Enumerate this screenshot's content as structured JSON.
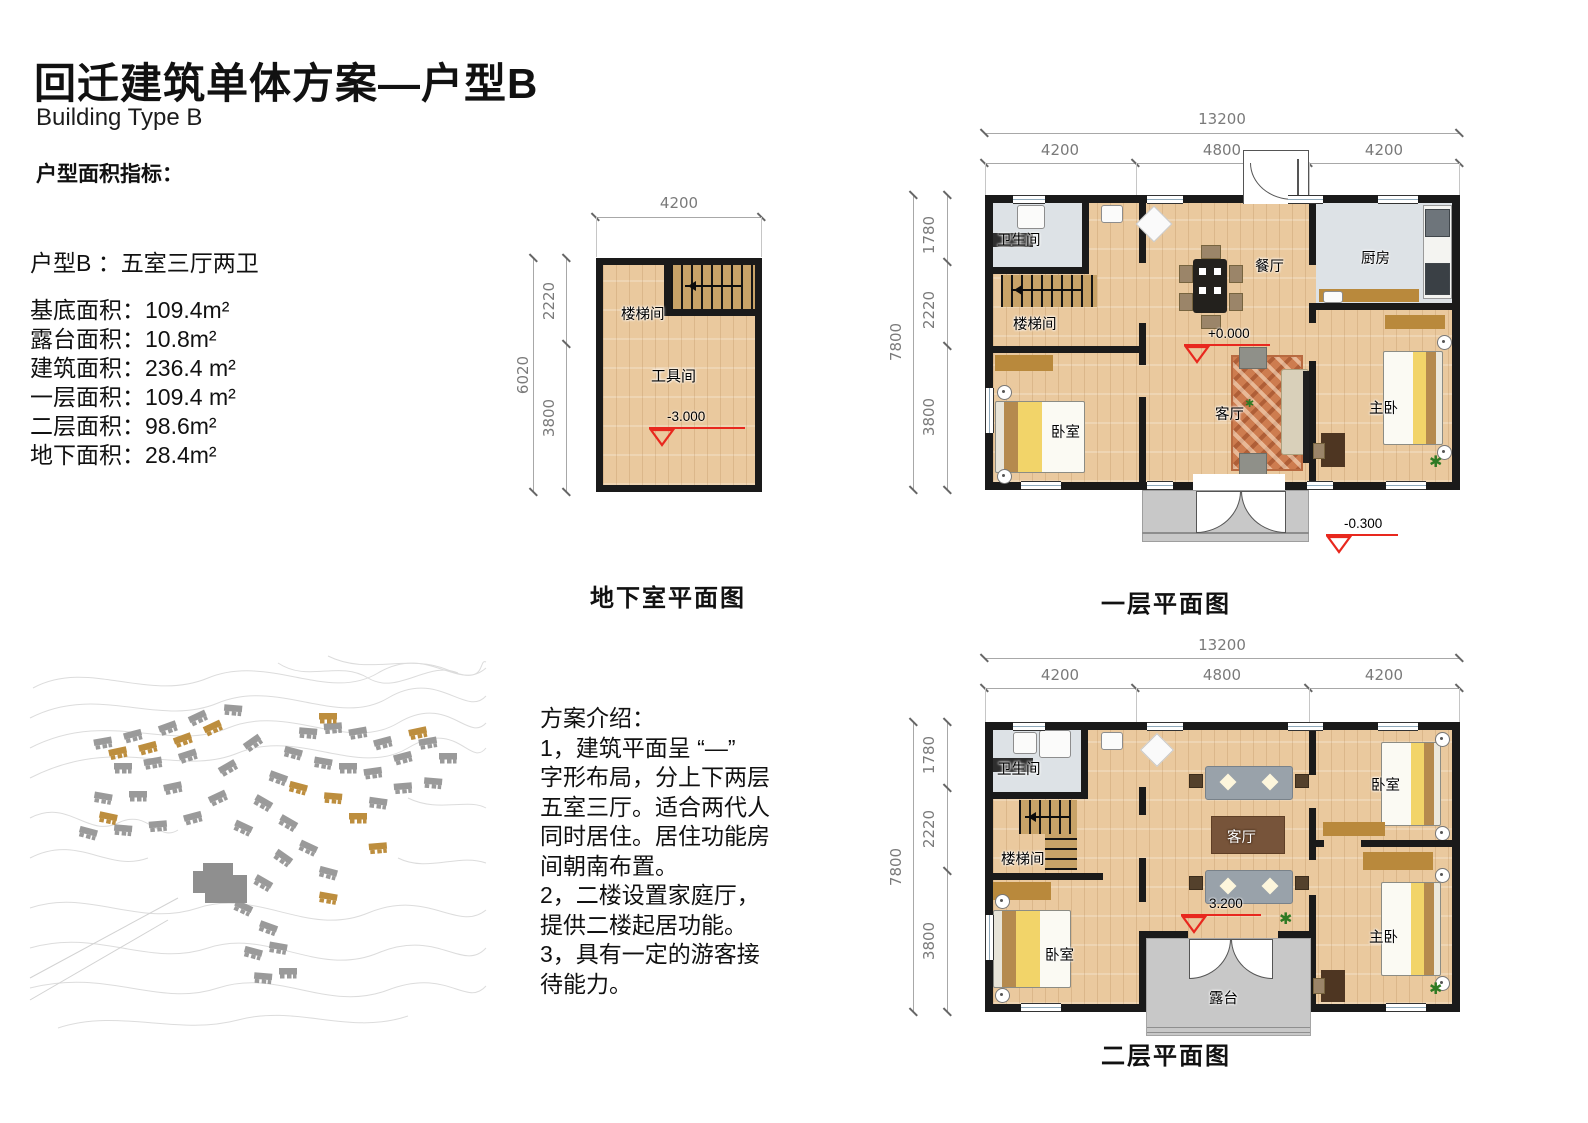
{
  "header": {
    "title": "回迁建筑单体方案—户型B",
    "subtitle": "Building Type B",
    "section_label": "户型面积指标："
  },
  "unit": {
    "type_line": "户型B ：五室三厅两卫",
    "area_lines": [
      "基底面积：109.4m²",
      "露台面积：10.8m²",
      "建筑面积：236.4 m²",
      "一层面积：109.4 m²",
      "二层面积：98.6m²",
      "地下面积：28.4m²"
    ]
  },
  "intro": "方案介绍：\n1，建筑平面呈 “—”\n字形布局，分上下两层\n五室三厅。适合两代人\n同时居住。居住功能房\n间朝南布置。\n2，二楼设置家庭厅，\n提供二楼起居功能。\n3，具有一定的游客接\n待能力。",
  "basement": {
    "caption": "地下室平面图",
    "dims": {
      "width": "4200",
      "height_total": "6020",
      "height_upper": "2220",
      "height_lower": "3800"
    },
    "rooms": {
      "stair": "楼梯间",
      "tool": "工具间"
    },
    "level": "-3.000"
  },
  "floor1": {
    "caption": "一层平面图",
    "dims": {
      "width_total": "13200",
      "w_left": "4200",
      "w_mid": "4800",
      "w_right": "4200",
      "height_total": "7800",
      "h_top": "1780",
      "h_mid": "2220",
      "h_bottom": "3800"
    },
    "rooms": {
      "bath": "卫生间",
      "stair": "楼梯间",
      "bedroom": "卧室",
      "dining": "餐厅",
      "living": "客厅",
      "kitchen": "厨房",
      "master": "主卧"
    },
    "levels": {
      "indoor": "+0.000",
      "outdoor": "-0.300"
    }
  },
  "floor2": {
    "caption": "二层平面图",
    "dims": {
      "width_total": "13200",
      "w_left": "4200",
      "w_mid": "4800",
      "w_right": "4200",
      "height_total": "7800",
      "h_top": "1780",
      "h_mid": "2220",
      "h_bottom": "3800"
    },
    "rooms": {
      "bath": "卫生间",
      "stair": "楼梯间",
      "bedroom_left": "卧室",
      "living": "客厅",
      "bedroom_right": "卧室",
      "master": "主卧",
      "terrace": "露台"
    },
    "level": "3.200"
  },
  "icons": {
    "plant": "✱"
  },
  "colors": {
    "wall": "#1a1a1a",
    "wood": "#eac99e",
    "tile": "#dde2e6",
    "stair_wood": "#c8a368",
    "accent_red": "#e8281e",
    "gold": "#b9893c",
    "concrete": "#c8c8c8",
    "map_gray": "#9a9a9a",
    "map_gold": "#bd8e3e"
  }
}
